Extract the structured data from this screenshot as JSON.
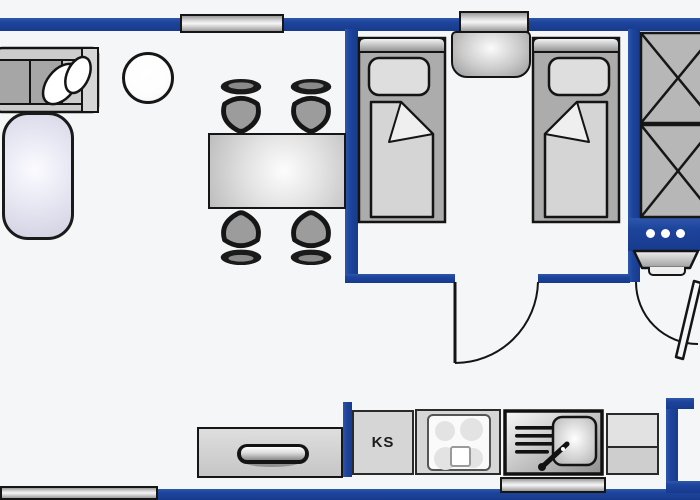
{
  "labels": {
    "refrigerator": "KS"
  },
  "palette": {
    "wall_blue": "#1d449c",
    "floor": "#f5f6f8",
    "furniture_gray": "#b7b7b7",
    "outline_dark": "#161616",
    "mat_lavender": "#e4e4f1"
  },
  "furniture": [
    "corner-sofa",
    "sofa-cushions",
    "round-table",
    "floor-mat",
    "dining-table",
    "dining-chair-top-left",
    "dining-chair-top-right",
    "dining-chair-bottom-left",
    "dining-chair-bottom-right",
    "single-bed-left",
    "single-bed-right",
    "nightstand",
    "wardrobe",
    "washbasin",
    "sideboard",
    "refrigerator",
    "stove",
    "sink-unit",
    "kitchen-counter"
  ],
  "openings": {
    "doors": 2,
    "windows_top": 2,
    "windows_bottom": 2
  }
}
